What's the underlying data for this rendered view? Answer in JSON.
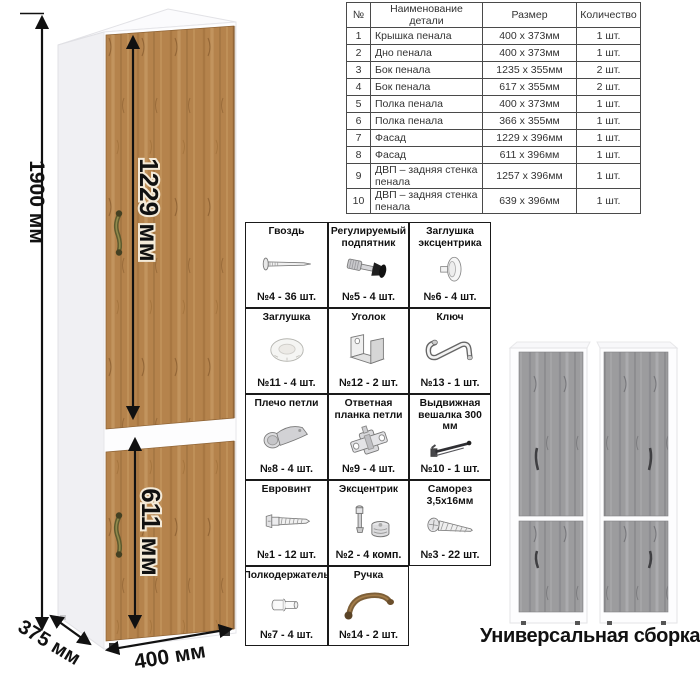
{
  "table": {
    "headers": [
      "№",
      "Наименование детали",
      "Размер",
      "Количество"
    ],
    "rows": [
      [
        "1",
        "Крышка пенала",
        "400 х 373мм",
        "1 шт."
      ],
      [
        "2",
        "Дно пенала",
        "400 х 373мм",
        "1 шт."
      ],
      [
        "3",
        "Бок пенала",
        "1235 х 355мм",
        "2 шт."
      ],
      [
        "4",
        "Бок пенала",
        "617 х 355мм",
        "2 шт."
      ],
      [
        "5",
        "Полка пенала",
        "400 х 373мм",
        "1 шт."
      ],
      [
        "6",
        "Полка пенала",
        "366 х 355мм",
        "1 шт."
      ],
      [
        "7",
        "Фасад",
        "1229 х 396мм",
        "1 шт."
      ],
      [
        "8",
        "Фасад",
        "611 х 396мм",
        "1 шт."
      ],
      [
        "9",
        "ДВП – задняя стенка пенала",
        "1257 х 396мм",
        "1 шт."
      ],
      [
        "10",
        "ДВП – задняя стенка пенала",
        "639 х 396мм",
        "1 шт."
      ]
    ]
  },
  "dimensions": {
    "height": "1900 мм",
    "upper_door": "1229 мм",
    "lower_door": "611 мм",
    "width": "400 мм",
    "depth": "375 мм"
  },
  "hardware": {
    "items": [
      {
        "title": "Гвоздь",
        "count": "№4 - 36 шт.",
        "icon": "nail-icon"
      },
      {
        "title": "Регулируемый подпятник",
        "count": "№5 - 4 шт.",
        "icon": "adjustable-foot-icon"
      },
      {
        "title": "Заглушка эксцентрика",
        "count": "№6 - 4 шт.",
        "icon": "cam-cover-icon"
      },
      {
        "title": "Заглушка",
        "count": "№11 - 4 шт.",
        "icon": "plug-icon"
      },
      {
        "title": "Уголок",
        "count": "№12 - 2 шт.",
        "icon": "corner-bracket-icon"
      },
      {
        "title": "Ключ",
        "count": "№13 - 1 шт.",
        "icon": "hex-key-icon"
      },
      {
        "title": "Плечо петли",
        "count": "№8 - 4 шт.",
        "icon": "hinge-arm-icon"
      },
      {
        "title": "Ответная планка петли",
        "count": "№9 - 4 шт.",
        "icon": "hinge-plate-icon"
      },
      {
        "title": "Выдвижная вешалка 300 мм",
        "count": "№10 - 1 шт.",
        "icon": "pullout-hanger-icon"
      },
      {
        "title": "Евровинт",
        "count": "№1 - 12 шт.",
        "icon": "euro-screw-icon"
      },
      {
        "title": "Эксцентрик",
        "count": "№2 - 4 комп.",
        "icon": "cam-lock-icon"
      },
      {
        "title": "Саморез 3,5х16мм",
        "count": "№3 - 22 шт.",
        "icon": "self-tapping-screw-icon"
      },
      {
        "title": "Полкодержатель",
        "count": "№7 - 4 шт.",
        "icon": "shelf-pin-icon"
      },
      {
        "title": "Ручка",
        "count": "№14 - 2 шт.",
        "icon": "handle-icon"
      }
    ]
  },
  "footer": {
    "caption": "Универсальная сборка."
  },
  "colors": {
    "oak_wood": "#b5834c",
    "gray_wood": "#9c9c9e",
    "handle_bronze": "#6e6838",
    "dimension_line": "#111111"
  }
}
